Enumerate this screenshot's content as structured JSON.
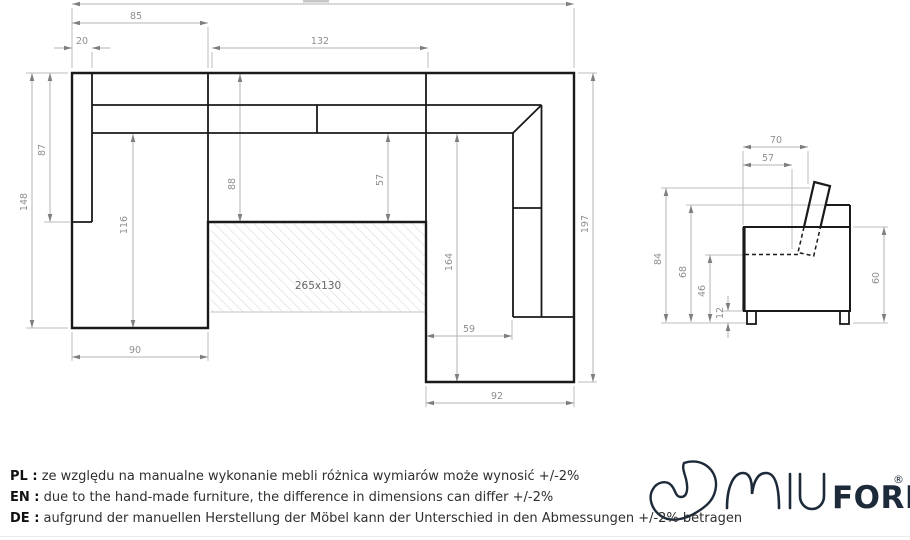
{
  "drawing": {
    "top_view": {
      "bed_area_label": "265x130",
      "dim_85": "85",
      "dim_20": "20",
      "dim_132": "132",
      "dim_148": "148",
      "dim_87": "87",
      "dim_116": "116",
      "dim_88": "88",
      "dim_57": "57",
      "dim_164": "164",
      "dim_197": "197",
      "dim_59": "59",
      "dim_90": "90",
      "dim_92": "92"
    },
    "side_view": {
      "dim_70": "70",
      "dim_57": "57",
      "dim_84": "84",
      "dim_68": "68",
      "dim_46": "46",
      "dim_12": "12",
      "dim_60": "60"
    }
  },
  "notes": [
    {
      "lang_label": "PL :",
      "text": "ze względu na manualne wykonanie mebli różnica wymiarów może wynosić +/-2%"
    },
    {
      "lang_label": "EN :",
      "text": "due to the hand-made furniture, the difference in dimensions can differ +/-2%"
    },
    {
      "lang_label": "DE :",
      "text": "aufgrund der manuellen Herstellung der Möbel kann der Unterschied in den Abmessungen +/-2% betragen"
    }
  ],
  "logo": {
    "brand_iu": "IU",
    "brand_form": "FORM",
    "registered": "®"
  },
  "colors": {
    "outline": "#1a1a1a",
    "dimension": "#b3b3b3",
    "dimension_text": "#8f8f8f",
    "hatch": "#d9d9d9",
    "logo": "#1d2a39"
  }
}
